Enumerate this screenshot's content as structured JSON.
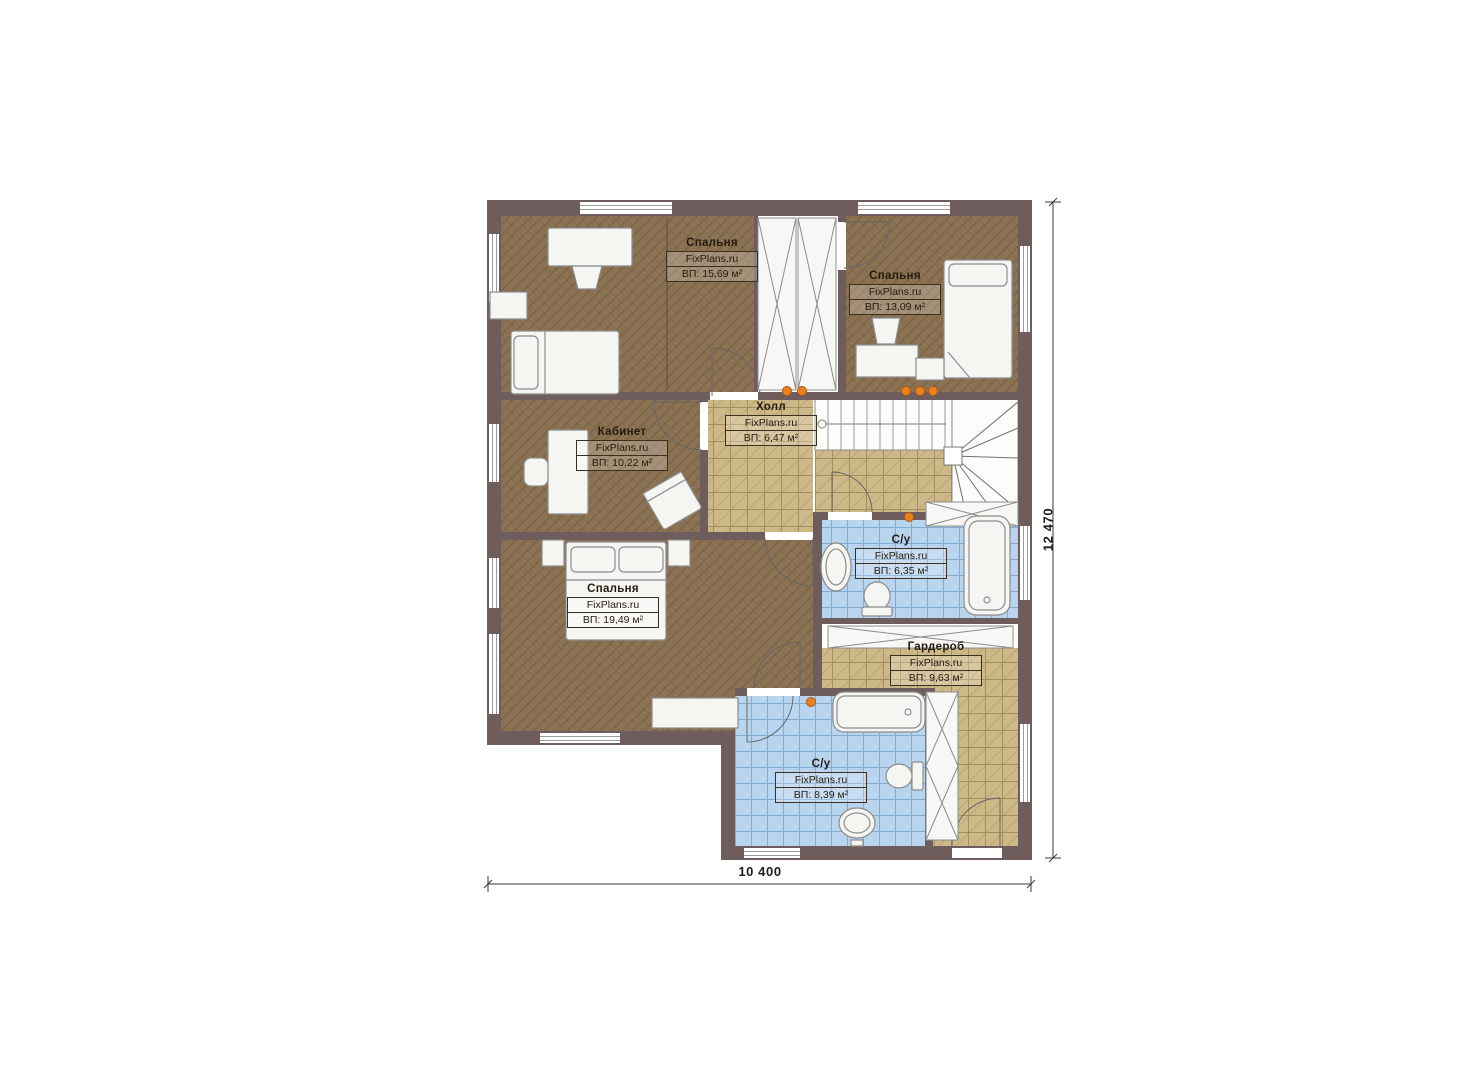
{
  "rooms": [
    {
      "name": "Спальня",
      "brand": "FixPlans.ru",
      "area": "ВП: 15,69 м²"
    },
    {
      "name": "Спальня",
      "brand": "FixPlans.ru",
      "area": "ВП: 13,09 м²"
    },
    {
      "name": "Холл",
      "brand": "FixPlans.ru",
      "area": "ВП: 6,47 м²"
    },
    {
      "name": "Кабинет",
      "brand": "FixPlans.ru",
      "area": "ВП: 10,22 м²"
    },
    {
      "name": "Спальня",
      "brand": "FixPlans.ru",
      "area": "ВП: 19,49 м²"
    },
    {
      "name": "С/у",
      "brand": "FixPlans.ru",
      "area": "ВП: 6,35 м²"
    },
    {
      "name": "Гардероб",
      "brand": "FixPlans.ru",
      "area": "ВП: 9,63 м²"
    },
    {
      "name": "С/у",
      "brand": "FixPlans.ru",
      "area": "ВП: 8,39 м²"
    }
  ],
  "dimensions": {
    "height": "12 470",
    "width": "10 400"
  },
  "colors": {
    "wall": "#6f5d5e",
    "floor_wood": "#8b7253",
    "floor_tile_tan": "#cdb988",
    "floor_tile_blue": "#b9d4ef",
    "light_dot": "#e8821e"
  }
}
